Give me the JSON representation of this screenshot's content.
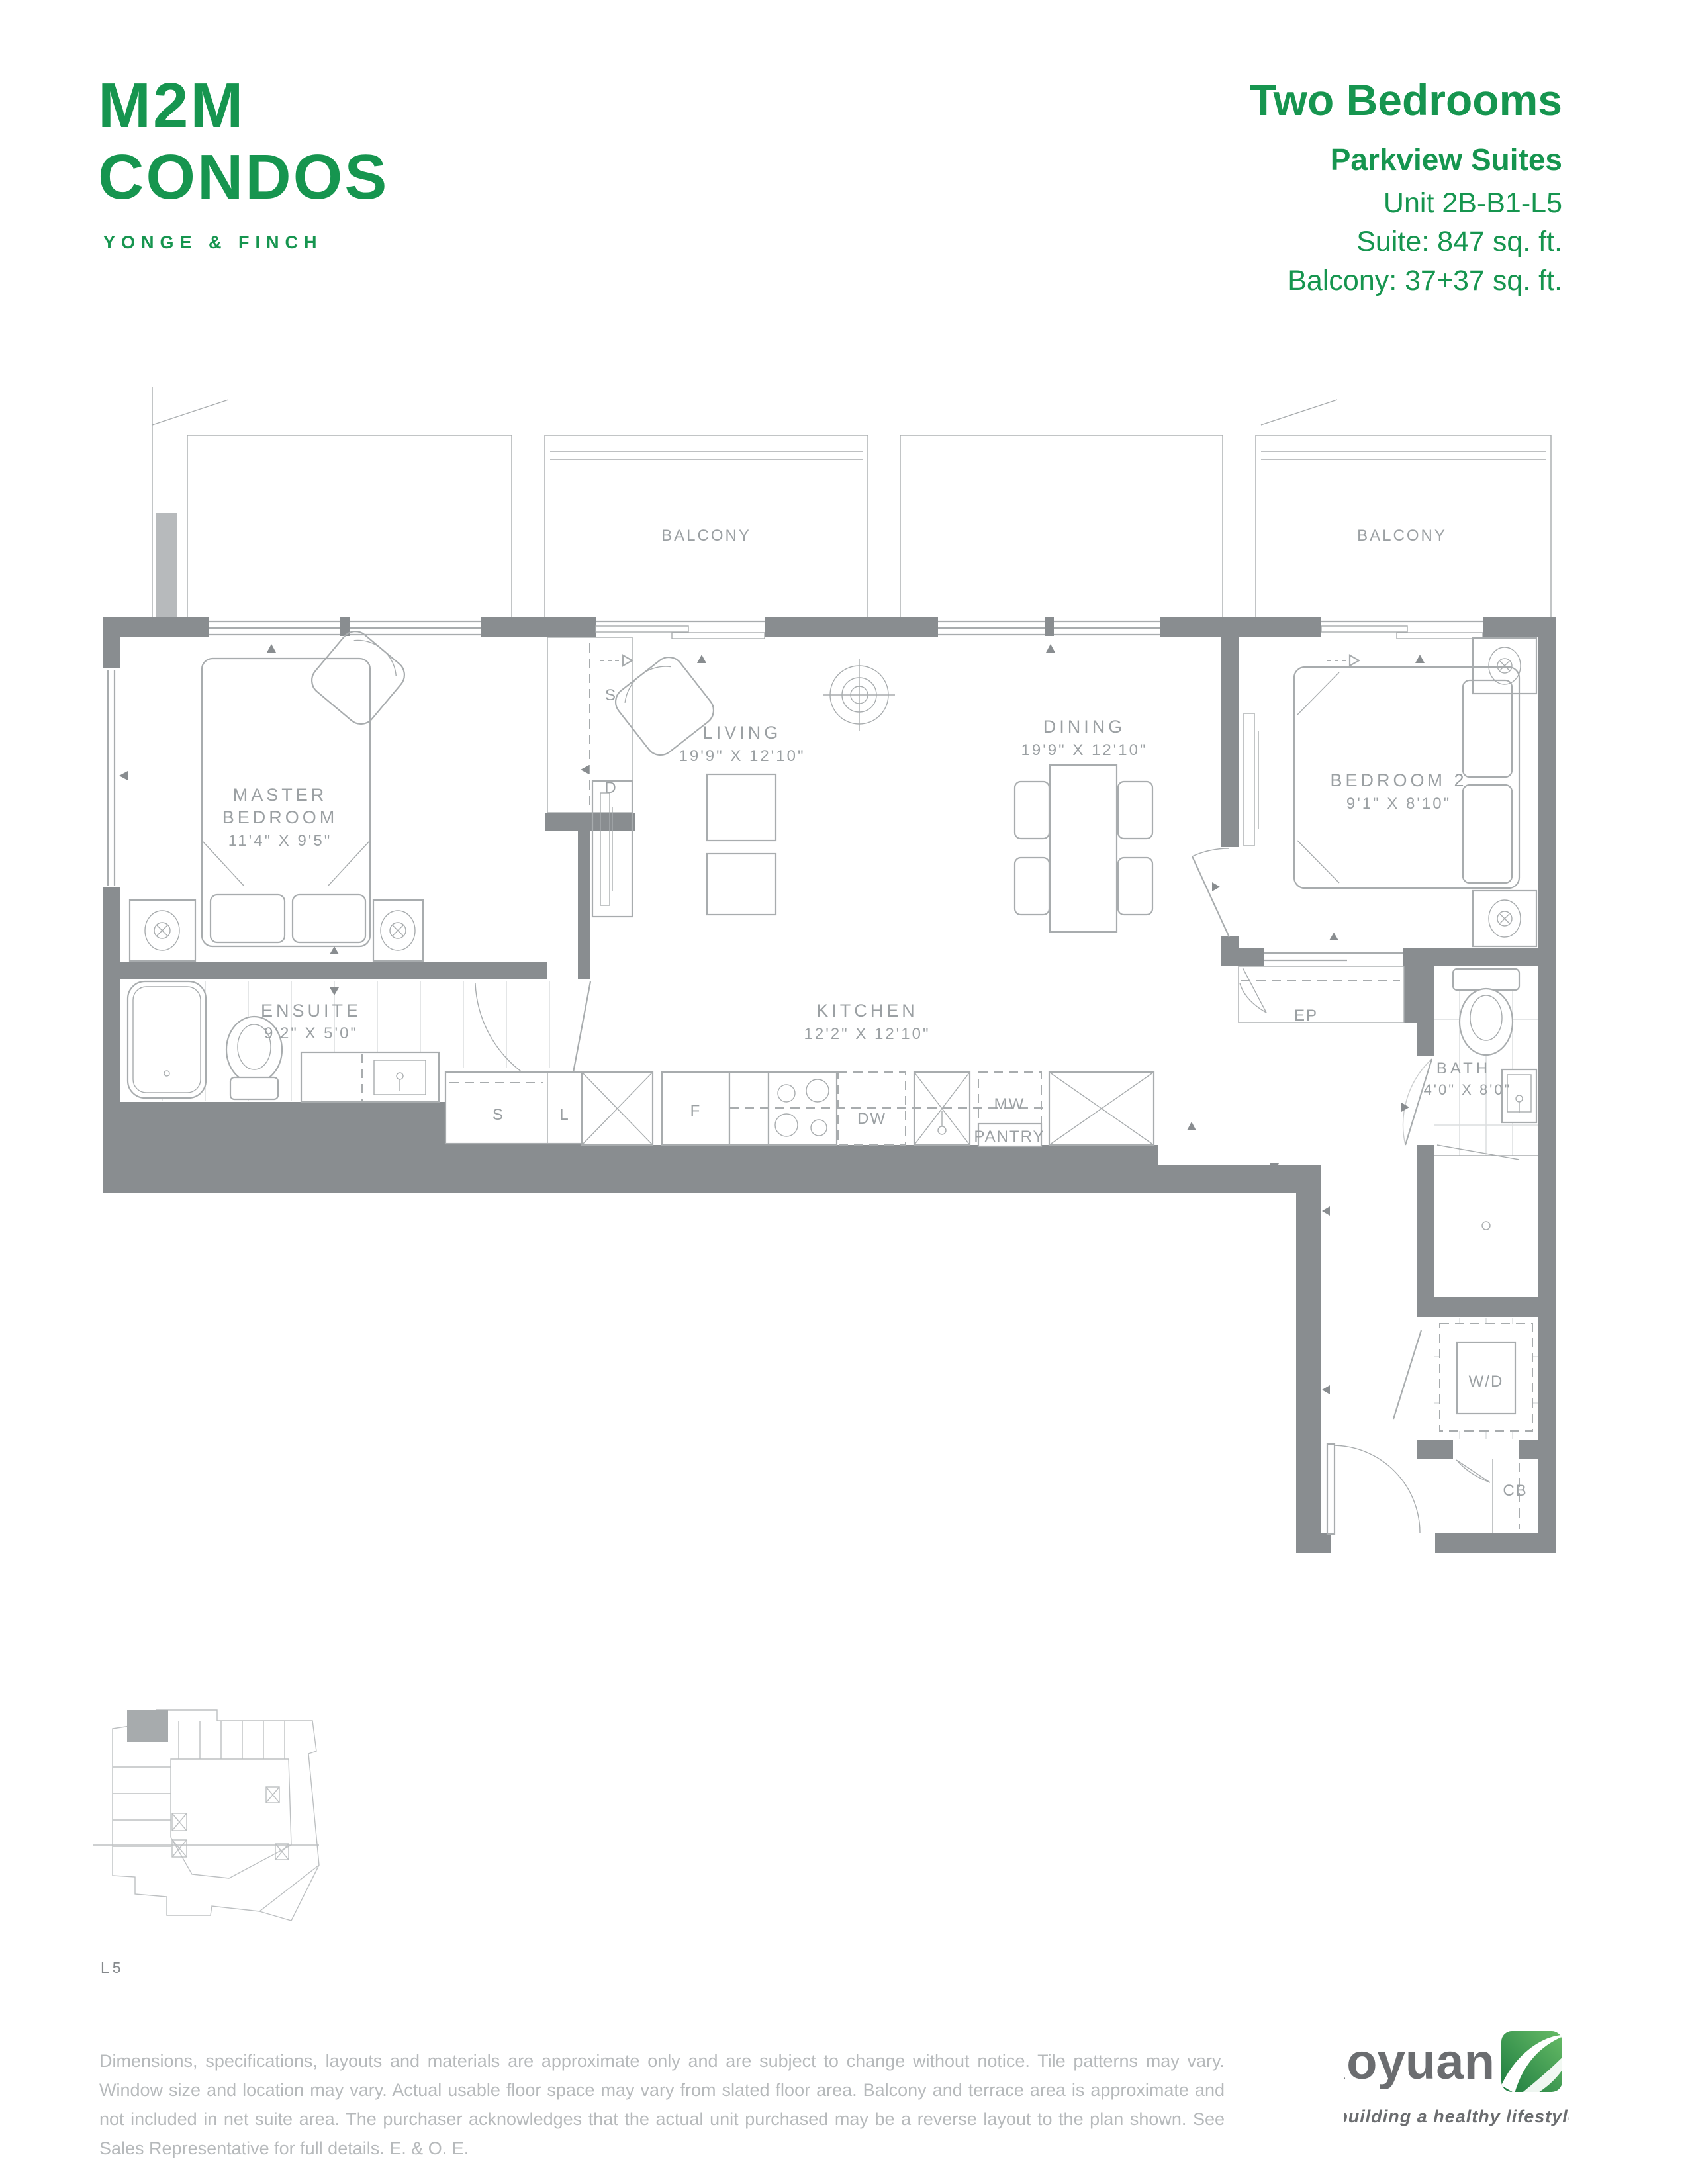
{
  "header": {
    "logo": {
      "line1": "M2M",
      "line2": "CONDOS",
      "tagline": "YONGE & FINCH"
    },
    "plan": {
      "type": "Two Bedrooms",
      "collection": "Parkview Suites",
      "unit": "Unit 2B-B1-L5",
      "suite_area": "Suite: 847 sq. ft.",
      "balcony_area": "Balcony: 37+37 sq. ft."
    }
  },
  "colors": {
    "brand_green": "#16954F",
    "wall_gray": "#898d90",
    "line_gray": "#a8acae"
  },
  "floorplan": {
    "balcony_label": "BALCONY",
    "rooms": {
      "master": {
        "name1": "MASTER",
        "name2": "BEDROOM",
        "dims": "11'4\" X 9'5\""
      },
      "living": {
        "name": "LIVING",
        "dims": "19'9\" X 12'10\""
      },
      "dining": {
        "name": "DINING",
        "dims": "19'9\" X 12'10\""
      },
      "bedroom2": {
        "name": "BEDROOM 2",
        "dims": "9'1\" X 8'10\""
      },
      "ensuite": {
        "name": "ENSUITE",
        "dims": "9'2\" X 5'0\""
      },
      "kitchen": {
        "name": "KITCHEN",
        "dims": "12'2\" X 12'10\""
      },
      "bath": {
        "name": "BATH",
        "dims": "4'0\" X 8'0\""
      }
    },
    "labels": {
      "closet_s": "S",
      "closet_d": "D",
      "linen_s": "S",
      "linen_l": "L",
      "fridge": "F",
      "dishwasher": "DW",
      "microwave": "MW",
      "pantry": "PANTRY",
      "electrical_panel": "EP",
      "washer_dryer": "W/D",
      "coat_closet": "CB"
    }
  },
  "keyplan": {
    "level": "L5"
  },
  "footer": {
    "disclaimer": "Dimensions, specifications, layouts and materials are approximate only and are subject to change without notice. Tile patterns may vary. Window size and location may vary. Actual usable floor space may vary from slated floor area. Balcony and terrace area is approximate and not included in net suite area. The purchaser acknowledges that the actual unit purchased may be a reverse layout to the plan shown. See Sales Representative for full details. E. & O. E.",
    "brand": "Aoyuan",
    "brand_tagline": "building a healthy lifestyle"
  }
}
